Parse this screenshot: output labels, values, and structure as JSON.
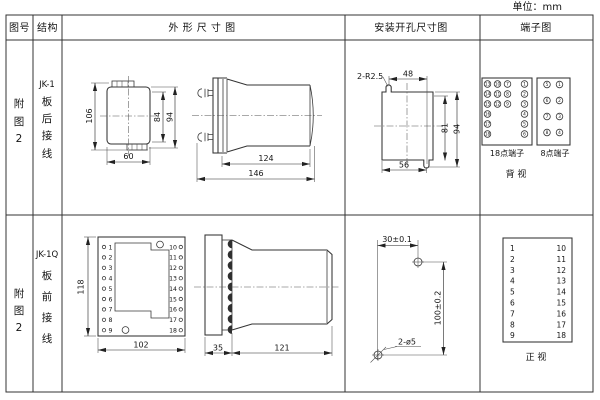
{
  "unit_label": "单位：mm",
  "header": {
    "fig_no": "图号",
    "structure": "结构",
    "outline": "外 形 尺 寸 图",
    "install": "安装开孔尺寸图",
    "terminal": "端子图"
  },
  "row1": {
    "fig": [
      "附",
      "图",
      "2"
    ],
    "structure": [
      "JK-1",
      "板",
      "后",
      "接",
      "线"
    ],
    "front_dims": {
      "height_total": "106",
      "height_inner": "84",
      "height_outer": "94",
      "width": "60"
    },
    "side_dims": {
      "body": "124",
      "total": "146"
    },
    "install_dims": {
      "slot_label": "2-R2.5",
      "top": "48",
      "right_inner": "81",
      "right_outer": "94",
      "bottom": "56"
    },
    "terminal": {
      "t18_label": "18点端子",
      "t8_label": "8点端子",
      "view_label": "背 视",
      "t18_rows": [
        [
          "13",
          "10",
          "7",
          "1"
        ],
        [
          "14",
          "11",
          "8",
          "2"
        ],
        [
          "15",
          "12",
          "9",
          "3"
        ],
        [
          "16",
          "",
          "",
          "4"
        ],
        [
          "17",
          "",
          "",
          "5"
        ],
        [
          "18",
          "",
          "",
          "6"
        ]
      ],
      "t8_rows": [
        [
          "5",
          "1"
        ],
        [
          "6",
          "2"
        ],
        [
          "7",
          "3"
        ],
        [
          "8",
          "4"
        ]
      ]
    }
  },
  "row2": {
    "fig": [
      "附",
      "图",
      "2"
    ],
    "structure": [
      "JK-1Q",
      "板",
      "前",
      "接",
      "线"
    ],
    "front_dims": {
      "height": "118",
      "width": "102"
    },
    "front_terminals_left": [
      "1",
      "2",
      "3",
      "4",
      "5",
      "6",
      "7",
      "8",
      "9"
    ],
    "front_terminals_right": [
      "10",
      "11",
      "12",
      "13",
      "14",
      "15",
      "16",
      "17",
      "18"
    ],
    "side_dims": {
      "flange": "35",
      "body": "121"
    },
    "install_dims": {
      "horizontal": "30±0.1",
      "vertical": "100±0.2",
      "holes_label": "2-ø5"
    },
    "terminal": {
      "view_label": "正 视",
      "left": [
        "1",
        "2",
        "3",
        "4",
        "5",
        "6",
        "7",
        "8",
        "9"
      ],
      "right": [
        "10",
        "11",
        "12",
        "13",
        "14",
        "15",
        "16",
        "17",
        "18"
      ]
    }
  }
}
